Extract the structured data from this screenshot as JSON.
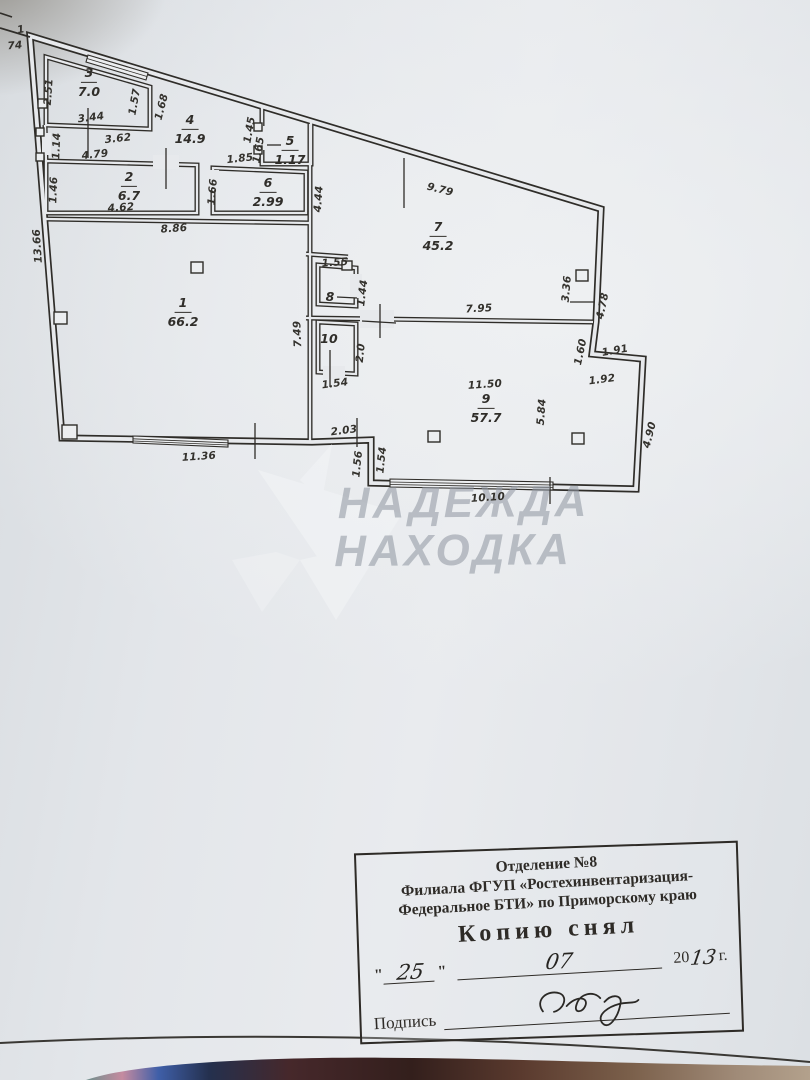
{
  "colors": {
    "paper": "#e7e9ec",
    "ink": "#2f2d29",
    "watermark_gray": "#969ea7",
    "stamp_ink": "#2e2b27"
  },
  "watermark": {
    "line1": "НАДЕЖДА",
    "line2": "НАХОДКА"
  },
  "stamp": {
    "dept_line1": "Отделение №8",
    "dept_line2": "Филиала ФГУП «Ростехинвентаризация-",
    "dept_line3": "Федеральное БТИ» по Приморскому краю",
    "title": "Копию снял",
    "quote_open": "\"",
    "quote_close": "\"",
    "day": "25",
    "month": "07",
    "year_prefix": "20",
    "year": "13",
    "year_suffix": "г.",
    "signature_label": "Подпись"
  },
  "plan": {
    "rooms": [
      {
        "num": "1",
        "area": "66.2",
        "x": 183,
        "y": 312
      },
      {
        "num": "2",
        "area": "6.7",
        "x": 129,
        "y": 186
      },
      {
        "num": "3",
        "area": "7.0",
        "x": 89,
        "y": 82
      },
      {
        "num": "4",
        "area": "14.9",
        "x": 190,
        "y": 129
      },
      {
        "num": "5",
        "area": "1.17",
        "x": 290,
        "y": 150
      },
      {
        "num": "6",
        "area": "2.99",
        "x": 268,
        "y": 192
      },
      {
        "num": "7",
        "area": "45.2",
        "x": 438,
        "y": 236
      },
      {
        "num": "8",
        "area": "",
        "x": 330,
        "y": 297
      },
      {
        "num": "9",
        "area": "57.7",
        "x": 486,
        "y": 408
      },
      {
        "num": "10",
        "area": "",
        "x": 329,
        "y": 339
      }
    ],
    "dimension_labels": [
      {
        "t": "1",
        "x": 21,
        "y": 30,
        "r": -10
      },
      {
        "t": "74",
        "x": 15,
        "y": 46,
        "r": -5
      },
      {
        "t": "2.51",
        "x": 49,
        "y": 92,
        "r": -86
      },
      {
        "t": "3.44",
        "x": 91,
        "y": 118,
        "r": -7
      },
      {
        "t": "1.57",
        "x": 135,
        "y": 102,
        "r": -80
      },
      {
        "t": "1.68",
        "x": 162,
        "y": 107,
        "r": -76
      },
      {
        "t": "3.62",
        "x": 118,
        "y": 139,
        "r": -6
      },
      {
        "t": "4.79",
        "x": 95,
        "y": 155,
        "r": -6
      },
      {
        "t": "1.14",
        "x": 57,
        "y": 146,
        "r": -88
      },
      {
        "t": "1.45",
        "x": 250,
        "y": 130,
        "r": -80
      },
      {
        "t": "1.85",
        "x": 240,
        "y": 159,
        "r": -6
      },
      {
        "t": "1.65",
        "x": 259,
        "y": 150,
        "r": -80
      },
      {
        "t": "1.46",
        "x": 54,
        "y": 190,
        "r": -88
      },
      {
        "t": "4.62",
        "x": 121,
        "y": 208,
        "r": -4
      },
      {
        "t": "1.66",
        "x": 213,
        "y": 192,
        "r": -85
      },
      {
        "t": "8.86",
        "x": 174,
        "y": 229,
        "r": -4
      },
      {
        "t": "13.66",
        "x": 38,
        "y": 246,
        "r": -94
      },
      {
        "t": "4.44",
        "x": 319,
        "y": 199,
        "r": -86
      },
      {
        "t": "9.79",
        "x": 440,
        "y": 190,
        "r": 14
      },
      {
        "t": "3.36",
        "x": 567,
        "y": 289,
        "r": -85
      },
      {
        "t": "4.78",
        "x": 603,
        "y": 306,
        "r": -78
      },
      {
        "t": "1.55",
        "x": 335,
        "y": 263,
        "r": -4
      },
      {
        "t": "1.44",
        "x": 363,
        "y": 293,
        "r": -83
      },
      {
        "t": "7.95",
        "x": 479,
        "y": 309,
        "r": -3
      },
      {
        "t": "7.49",
        "x": 298,
        "y": 334,
        "r": -92
      },
      {
        "t": "2.0",
        "x": 361,
        "y": 353,
        "r": -84
      },
      {
        "t": "1.60",
        "x": 581,
        "y": 352,
        "r": -78
      },
      {
        "t": "1.91",
        "x": 615,
        "y": 351,
        "r": -10
      },
      {
        "t": "1.92",
        "x": 602,
        "y": 380,
        "r": -7
      },
      {
        "t": "11.50",
        "x": 485,
        "y": 385,
        "r": -4
      },
      {
        "t": "5.84",
        "x": 542,
        "y": 412,
        "r": -86
      },
      {
        "t": "4.90",
        "x": 650,
        "y": 435,
        "r": -76
      },
      {
        "t": "1.54",
        "x": 335,
        "y": 384,
        "r": -7
      },
      {
        "t": "2.03",
        "x": 344,
        "y": 431,
        "r": -7
      },
      {
        "t": "1.56",
        "x": 358,
        "y": 464,
        "r": -84
      },
      {
        "t": "1.54",
        "x": 382,
        "y": 460,
        "r": -84
      },
      {
        "t": "11.36",
        "x": 199,
        "y": 457,
        "r": -4
      },
      {
        "t": "10.10",
        "x": 488,
        "y": 498,
        "r": -4
      }
    ]
  }
}
